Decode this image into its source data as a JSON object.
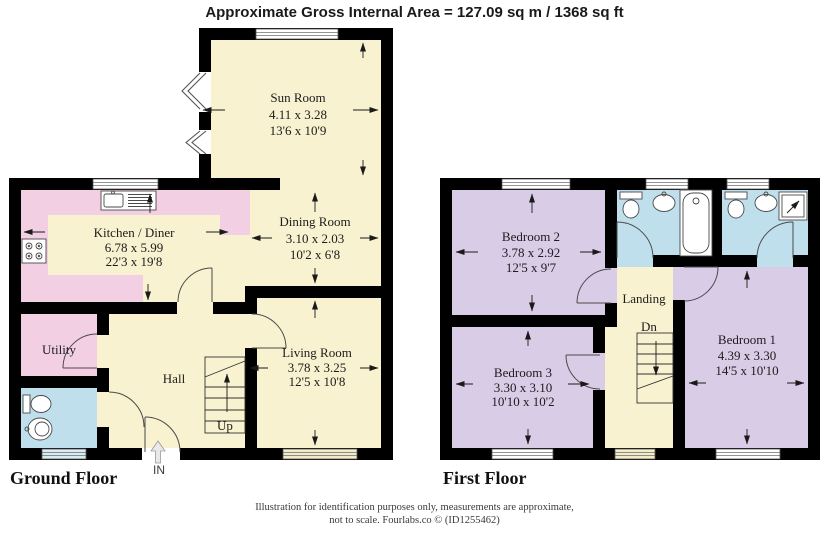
{
  "title": "Approximate Gross Internal Area = 127.09 sq m / 1368 sq ft",
  "floors": {
    "ground": {
      "label": "Ground Floor",
      "stairs_label": "Up",
      "entrance_label": "IN",
      "rooms": {
        "sun_room": {
          "name": "Sun Room",
          "metric": "4.11 x 3.28",
          "imperial": "13'6 x 10'9"
        },
        "kitchen": {
          "name": "Kitchen / Diner",
          "metric": "6.78 x 5.99",
          "imperial": "22'3 x 19'8"
        },
        "dining": {
          "name": "Dining Room",
          "metric": "3.10 x 2.03",
          "imperial": "10'2 x 6'8"
        },
        "living": {
          "name": "Living Room",
          "metric": "3.78 x 3.25",
          "imperial": "12'5 x 10'8"
        },
        "utility": {
          "name": "Utility"
        },
        "hall": {
          "name": "Hall"
        }
      }
    },
    "first": {
      "label": "First Floor",
      "stairs_label": "Dn",
      "rooms": {
        "bedroom1": {
          "name": "Bedroom 1",
          "metric": "4.39 x 3.30",
          "imperial": "14'5 x 10'10"
        },
        "bedroom2": {
          "name": "Bedroom 2",
          "metric": "3.78 x 2.92",
          "imperial": "12'5 x 9'7"
        },
        "bedroom3": {
          "name": "Bedroom 3",
          "metric": "3.30 x 3.10",
          "imperial": "10'10 x 10'2"
        },
        "landing": {
          "name": "Landing"
        }
      }
    }
  },
  "footer": {
    "line1": "Illustration for identification purposes only, measurements are approximate,",
    "line2": "not to scale. Fourlabs.co © (ID1255462)"
  },
  "colors": {
    "cream": "#f9f2d0",
    "pink": "#f2cfe3",
    "purple": "#d9cce6",
    "blue": "#bfdfec",
    "wall": "#000000"
  }
}
